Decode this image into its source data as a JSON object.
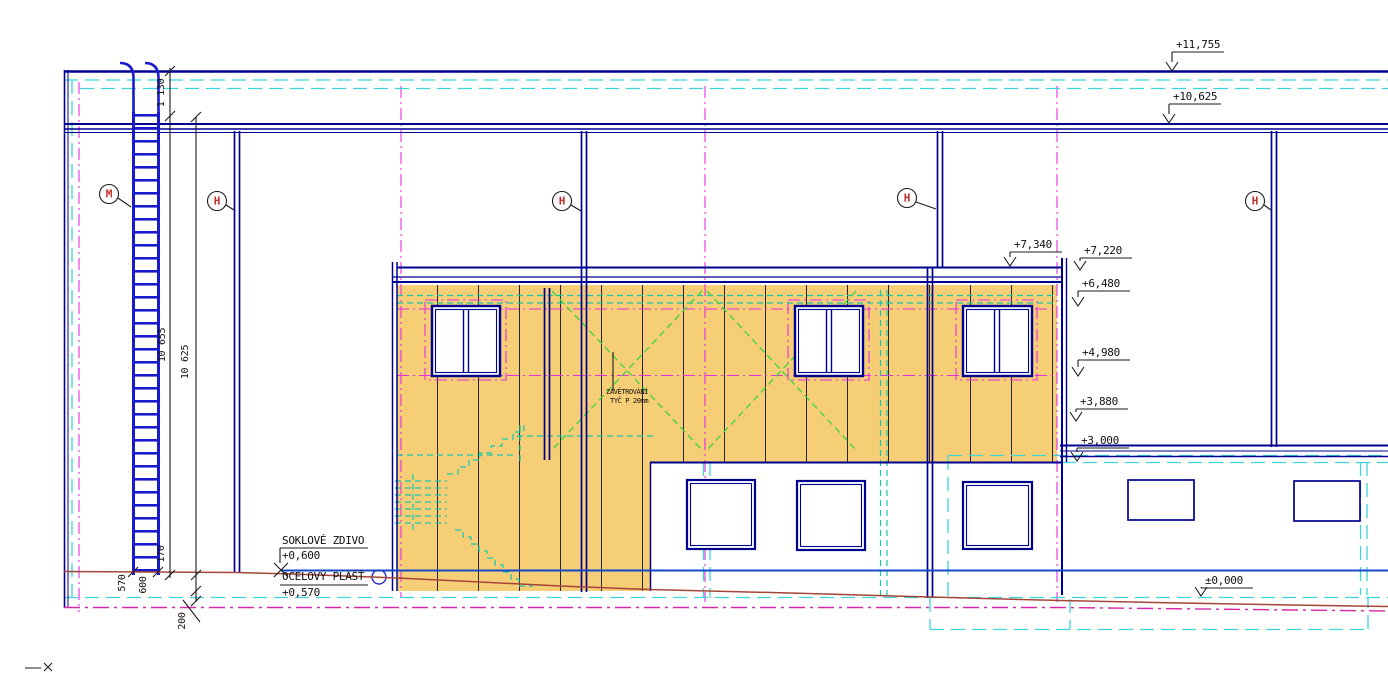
{
  "elevations": {
    "roof_top": "+11,755",
    "eaves": "+10,625",
    "annex_parapet": "+7,340",
    "annex_edge_top": "+7,220",
    "annex_soffit": "+6,480",
    "window_head": "+4,980",
    "mid_level": "+3,880",
    "low_roof": "+3,000",
    "ground": "±0,000"
  },
  "dimensions": {
    "total_height_outer": "10 655",
    "total_height_inner": "10 625",
    "ladder_cage": "1 130",
    "base_570": "570",
    "base_600": "600",
    "base_170": "170",
    "base_200": "200"
  },
  "annotations": {
    "plinth": "SOKLOVÉ ZDIVO",
    "plinth_level": "+0,600",
    "steel_shell": "OCELOVÝ PLÁŠŤ",
    "steel_shell_level": "+0,570",
    "bracing": "ZAVĚTROVÁNÍ",
    "bracing_spec": "TYČ P 20mm"
  },
  "grid_markers": {
    "m": "M",
    "h": "H"
  },
  "colors": {
    "structure_navy": "#000090",
    "ladder_blue": "#1a1acd",
    "cladding_yellow": "#f6ce76",
    "axis_magenta": "#e62ee0",
    "hidden_cyan": "#3cd6da",
    "stair_teal": "#17c8ac",
    "bracing_green": "#3fd43f",
    "terrain_red": "#a5453a",
    "terrain_magenta": "#d428a8",
    "level_blue": "#1549c8",
    "marker_red": "#c42b2b"
  }
}
